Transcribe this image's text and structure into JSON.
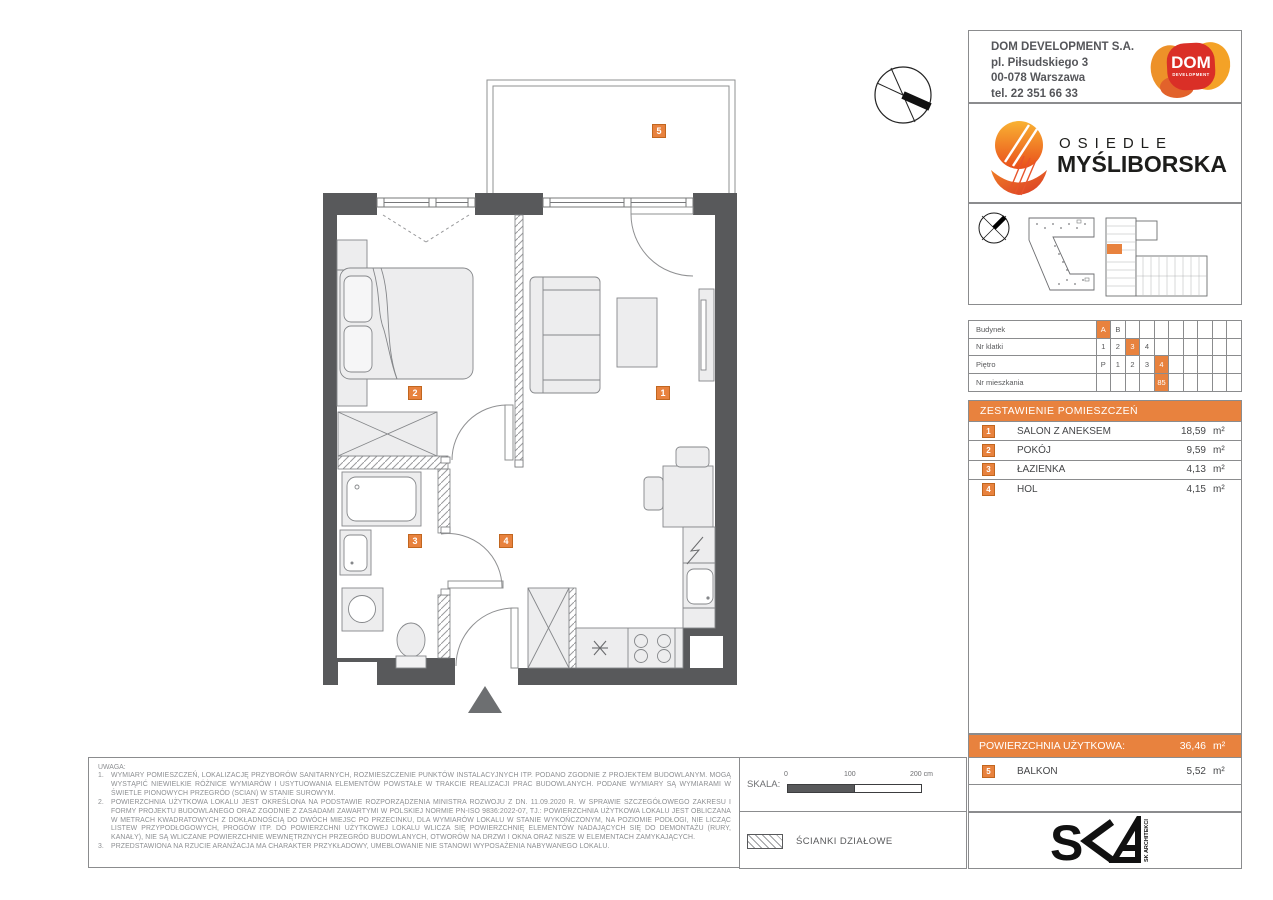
{
  "colors": {
    "accent": "#e8823e",
    "wall": "#58595b"
  },
  "developer": {
    "name": "DOM DEVELOPMENT S.A.",
    "address_line1": "pl. Piłsudskiego 3",
    "address_line2": "00-078 Warszawa",
    "phone": "tel. 22 351 66 33",
    "logo_text": "DOM",
    "logo_subtext": "DEVELOPMENT"
  },
  "estate": {
    "line1": "OSIEDLE",
    "line2": "MYŚLIBORSKA"
  },
  "unit_table": {
    "rows": [
      {
        "label": "Budynek",
        "cells": [
          "A",
          "B",
          "",
          "",
          "",
          "",
          "",
          "",
          "",
          ""
        ],
        "highlight": 0
      },
      {
        "label": "Nr klatki",
        "cells": [
          "1",
          "2",
          "3",
          "4",
          "",
          "",
          "",
          "",
          "",
          ""
        ],
        "highlight": 2
      },
      {
        "label": "Piętro",
        "cells": [
          "P",
          "1",
          "2",
          "3",
          "4",
          "",
          "",
          "",
          "",
          ""
        ],
        "highlight": 4
      },
      {
        "label": "Nr mieszkania",
        "cells": [
          "",
          "",
          "",
          "",
          "85",
          "",
          "",
          "",
          "",
          ""
        ],
        "highlight": 4
      }
    ]
  },
  "rooms": {
    "header": "ZESTAWIENIE POMIESZCZEŃ",
    "items": [
      {
        "num": "1",
        "name": "SALON Z ANEKSEM",
        "area": "18,59",
        "unit": "m²"
      },
      {
        "num": "2",
        "name": "POKÓJ",
        "area": "9,59",
        "unit": "m²"
      },
      {
        "num": "3",
        "name": "ŁAZIENKA",
        "area": "4,13",
        "unit": "m²"
      },
      {
        "num": "4",
        "name": "HOL",
        "area": "4,15",
        "unit": "m²"
      }
    ]
  },
  "summary": {
    "label": "POWIERZCHNIA UŻYTKOWA:",
    "area": "36,46",
    "unit": "m²"
  },
  "balcony": {
    "num": "5",
    "name": "BALKON",
    "area": "5,52",
    "unit": "m²"
  },
  "plan_badges": [
    "1",
    "2",
    "3",
    "4",
    "5"
  ],
  "scale_bar": {
    "label": "SKALA:",
    "tick0": "0",
    "tick100": "100",
    "tick200": "200 cm"
  },
  "legend": {
    "label": "ŚCIANKI DZIAŁOWE"
  },
  "architect": {
    "vertical_label": "SK ARCHITEKCI"
  },
  "notes": {
    "heading": "UWAGA:",
    "items": [
      "WYMIARY POMIESZCZEŃ, LOKALIZACJĘ PRZYBORÓW SANITARNYCH, ROZMIESZCZENIE PUNKTÓW INSTALACYJNYCH ITP. PODANO ZGODNIE Z PROJEKTEM BUDOWLANYM. MOGĄ WYSTĄPIĆ NIEWIELKIE RÓŻNICE WYMIARÓW I USYTUOWANIA ELEMENTÓW POWSTAŁE W TRAKCIE REALIZACJI PRAC BUDOWLANYCH. PODANE WYMIARY SĄ WYMIARAMI W ŚWIETLE PIONOWYCH PRZEGRÓD (SCIAN) W STANIE SUROWYM.",
      "POWIERZCHNIA UŻYTKOWA LOKALU JEST OKREŚLONA NA PODSTAWIE ROZPORZĄDZENIA MINISTRA ROZWOJU Z DN. 11.09.2020 R. W SPRAWIE SZCZEGÓŁOWEGO ZAKRESU I FORMY PROJEKTU BUDOWLANEGO ORAZ ZGODNIE Z ZASADAMI ZAWARTYMI W POLSKIEJ NORMIE PN-ISO 9836:2022-07, TJ.: POWIERZCHNIA UŻYTKOWA LOKALU JEST OBLICZANA W METRACH KWADRATOWYCH Z DOKŁADNOŚCIĄ DO DWÓCH MIEJSC PO PRZECINKU, DLA WYMIARÓW LOKALU W STANIE WYKOŃCZONYM, NA POZIOMIE PODŁOGI, NIE LICZĄC LISTEW PRZYPODŁOGOWYCH, PROGÓW ITP. DO POWIERZCHNI UŻYTKOWEJ LOKALU WLICZA SIĘ POWIERZCHNIĘ ELEMENTÓW NADAJĄCYCH SIĘ DO DEMONTAŻU (RURY, KANAŁY), NIE SĄ WLICZANE POWIERZCHNIE WEWNĘTRZNYCH PRZEGRÓD BUDOWLANYCH, OTWORÓW NA DRZWI I OKNA ORAZ NISZE W ELEMENTACH ZAMYKAJĄCYCH.",
      "PRZEDSTAWIONA NA RZUCIE ARANŻACJA MA CHARAKTER PRZYKŁADOWY, UMEBLOWANIE NIE STANOWI WYPOSAŻENIA NABYWANEGO LOKALU."
    ]
  }
}
